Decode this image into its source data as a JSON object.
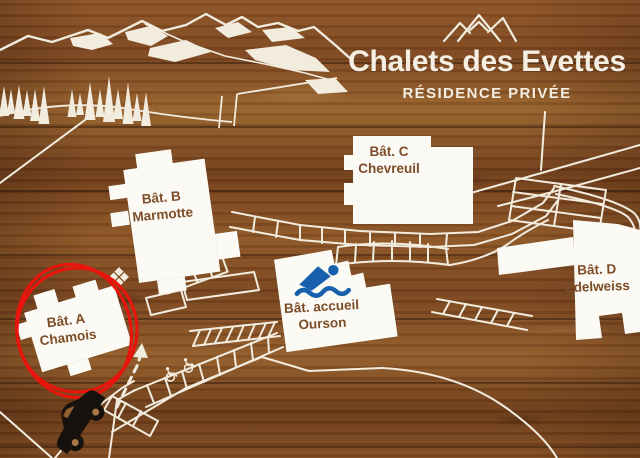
{
  "sign": {
    "title": "Chalets des Evettes",
    "subtitle": "RÉSIDENCE PRIVÉE",
    "logo": "mountain-peaks-icon"
  },
  "buildings": [
    {
      "name": "Bât. A",
      "subname": "Chamois",
      "annotation": "circled-in-red"
    },
    {
      "name": "Bât. B",
      "subname": "Marmotte"
    },
    {
      "name": "Bât. C",
      "subname": "Chevreuil"
    },
    {
      "name": "Bât. D",
      "subname": "Edelweiss"
    },
    {
      "name": "Bât. accueil",
      "subname": "Ourson",
      "icon": "swimmer-icon"
    }
  ],
  "map_symbols": {
    "swimming_pool": "swimmer-icon",
    "entrance_vehicle": "car-icon",
    "route_hint": "dashed-arrow-icon",
    "highlight": "red-circle-annotation",
    "accessible_parking_icon": "wheelchair-icon",
    "accessible_parking_spaces": 6
  },
  "colors": {
    "wood_light": "#a9713a",
    "wood_mid": "#86502a",
    "wood_dark": "#5f3318",
    "paint_white": "#f2ecdf",
    "building_fill": "#fbfaf4",
    "building_text": "#7d4c28",
    "pool_blue": "#1660ad",
    "highlight_red": "#e8150c",
    "car_black": "#17110d"
  }
}
